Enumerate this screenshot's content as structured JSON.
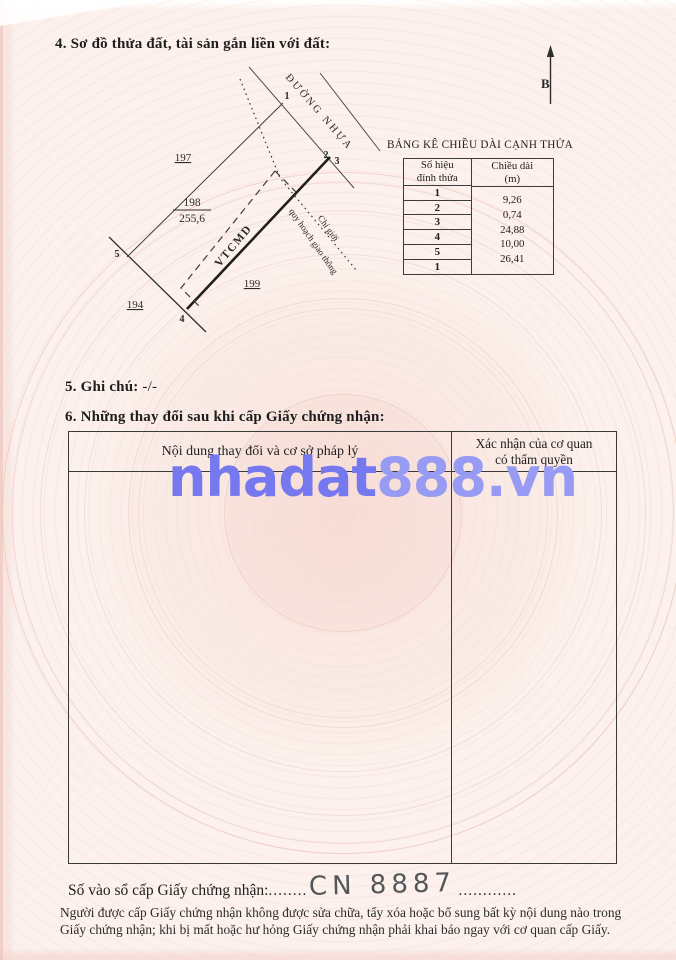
{
  "sections": {
    "s4_title": "4. Sơ đồ thửa đất, tài sản gắn liền với đất:",
    "s5_label": "5. Ghi chú:",
    "s5_value": "-/-",
    "s6_title": "6. Những thay đổi sau khi cấp Giấy chứng nhận:"
  },
  "diagram": {
    "north_label": "B",
    "road_label": "ĐƯỜNG NHỰA",
    "planning_label_line1": "Chỉ giới",
    "planning_label_line2": "quy hoạch giao thông",
    "parcel_code": "VTCMD",
    "parcel_number": "198",
    "parcel_area": "255,6",
    "neighbor_left": "197",
    "neighbor_right": "199",
    "neighbor_bottom": "194",
    "vertex_1": "1",
    "vertex_2": "2",
    "vertex_3": "3",
    "vertex_4": "4",
    "vertex_5": "5"
  },
  "length_table": {
    "title": "BẢNG KÊ CHIỀU DÀI CẠNH THỬA",
    "col1_header_line1": "Số hiệu",
    "col1_header_line2": "đỉnh thửa",
    "col2_header_line1": "Chiều dài",
    "col2_header_line2": "(m)",
    "vertices": [
      "1",
      "2",
      "3",
      "4",
      "5",
      "1"
    ],
    "lengths": [
      "9,26",
      "0,74",
      "24,88",
      "10,00",
      "26,41"
    ]
  },
  "changes_table": {
    "col1_header": "Nội dung thay đổi và cơ sở pháp lý",
    "col2_header_line1": "Xác nhận của cơ quan",
    "col2_header_line2": "có thẩm quyền"
  },
  "watermark": {
    "part1": "nhadat",
    "part2": "888.vn",
    "color1": "#7578ee",
    "color2": "#989bf3"
  },
  "registry": {
    "label": "Số vào sổ cấp Giấy chứng nhận:",
    "dots_before": "........",
    "value": "CN 8887",
    "dots_after": "............"
  },
  "footer": {
    "line1": "Người được cấp Giấy chứng nhận không được sửa chữa, tẩy xóa hoặc bổ sung bất kỳ nội dung nào trong",
    "line2": "Giấy chứng nhận; khi bị mất hoặc hư hỏng Giấy chứng nhận phải khai báo ngay với cơ quan cấp Giấy."
  }
}
